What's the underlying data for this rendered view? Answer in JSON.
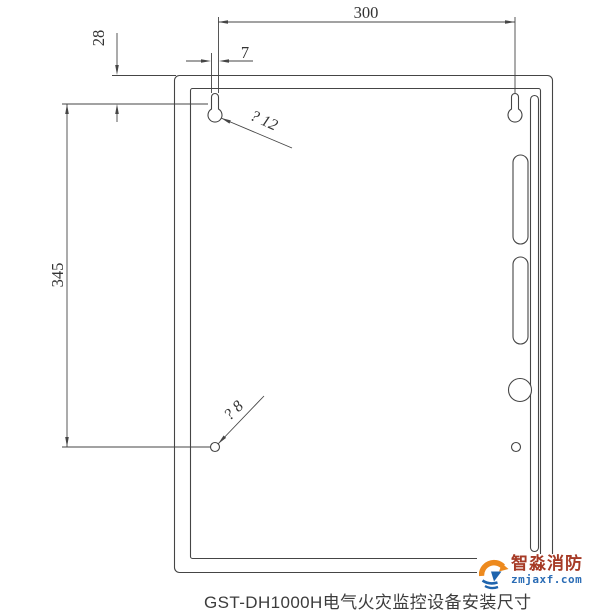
{
  "page": {
    "background": "#ffffff"
  },
  "diagram": {
    "caption": "GST-DH1000H电气火灾监控设备安装尺寸",
    "dimensions": {
      "top_width": "300",
      "top_offset": "28",
      "left_height": "345",
      "slot_width": "7",
      "keyhole_diameter": "? 12",
      "hole_diameter": "? 8"
    },
    "line_color": "#454545",
    "text_color": "#333333"
  },
  "watermark": {
    "brand": "智淼消防",
    "website": "zmjaxf.com",
    "brand_color": "#a63a26",
    "website_color": "#2a6cb5",
    "icon_orange": "#ed8a1e",
    "icon_blue": "#1f64ad"
  }
}
